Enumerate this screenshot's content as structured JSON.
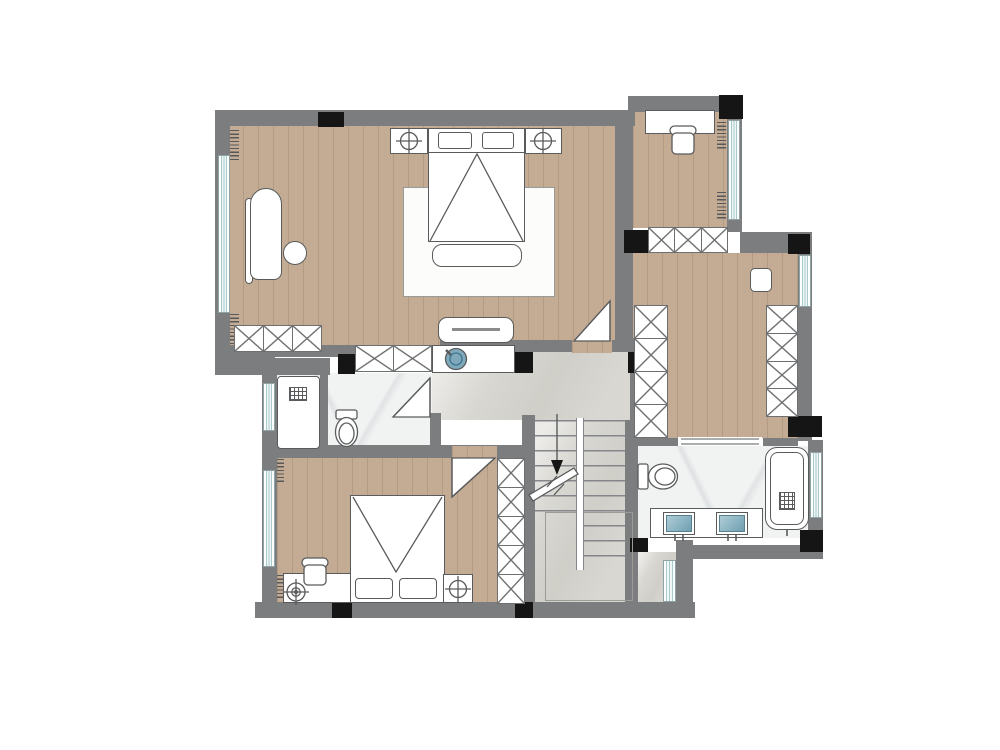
{
  "colors": {
    "bg": "#ffffff",
    "wall": "#7c7d7f",
    "column": "#151515",
    "wood": "#c3ab94",
    "marble": "#d8d7d1",
    "marbleLight": "#f1f2f2",
    "glassLine": "#a9c9cc",
    "stroke": "#5a5b5c",
    "hatch": "#6e6f71",
    "sinkBlue": "#7fa9ba"
  },
  "plan": {
    "kind": "residential floor plan, upper storey",
    "stairs_direction": "down",
    "stairs_shape": "u-shaped switchback, two flights with center stringer, break line and down arrow"
  },
  "rooms": [
    {
      "name": "master-bedroom",
      "floor": "wood",
      "items": [
        "double-bed",
        "blanket-fold-triangle",
        "two-pillows",
        "headboard",
        "nightstand-with-lamp-left",
        "nightstand-with-lamp-right",
        "foot-bench",
        "area-rug",
        "chaise-lounge",
        "round-ottoman",
        "tv-cabinet",
        "built-in-wardrobe",
        "window-left",
        "entry-door"
      ]
    },
    {
      "name": "study",
      "floor": "wood",
      "items": [
        "desk",
        "chair",
        "window-right",
        "closet"
      ]
    },
    {
      "name": "walk-in-closet",
      "floor": "wood",
      "items": [
        "wardrobe-left-run",
        "wardrobe-right-run",
        "square-ottoman",
        "window-right",
        "opening-to-bathroom"
      ]
    },
    {
      "name": "hallway",
      "floor": "marble",
      "items": [
        "vanity-counter",
        "round-vessel-sink",
        "wardrobe-strip"
      ]
    },
    {
      "name": "stairwell",
      "floor": "marble",
      "items": [
        "stair-flight-left",
        "stair-flight-right",
        "center-stringer",
        "down-arrow",
        "break-line",
        "landing-outline",
        "window-bottom"
      ]
    },
    {
      "name": "bathroom-1",
      "floor": "marble-white",
      "items": [
        "shower-tray-with-drain",
        "toilet",
        "swing-door",
        "window-left"
      ]
    },
    {
      "name": "bedroom-2",
      "floor": "wood",
      "items": [
        "double-bed",
        "blanket-fold-triangle",
        "two-pillows",
        "nightstand-with-lamp",
        "low-cabinet",
        "chair",
        "floor-fan-symbol",
        "wardrobe",
        "window-left",
        "entry-door"
      ]
    },
    {
      "name": "bathroom-2",
      "floor": "marble-white",
      "items": [
        "toilet",
        "double-sink-vanity",
        "two-inset-basins",
        "bathtub-with-drain",
        "window-right"
      ]
    }
  ],
  "symbols": {
    "x-hatched-box": "wardrobe / closet cabinetry",
    "striped-band": "window glazing",
    "black-square": "structural column",
    "gray-band": "wall",
    "crosshair-circle": "table lamp",
    "white-triangle-with-diagonal": "door swing"
  },
  "counts": {
    "windows": 7,
    "swing-doors": 3,
    "structural-columns": 12,
    "wardrobe-runs": 6,
    "bedrooms": 2,
    "bathrooms": 2
  }
}
